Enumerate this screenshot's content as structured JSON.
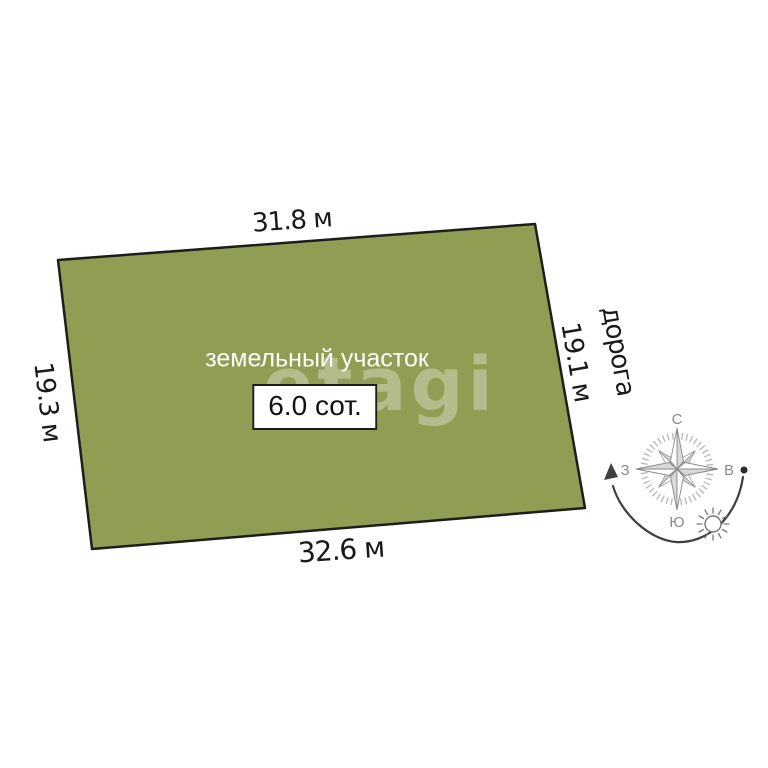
{
  "diagram": {
    "plot_label": "земельный участок",
    "area_label": "6.0 сот.",
    "dimensions": {
      "top": "31.8 м",
      "left": "19.3 м",
      "right": "19.1 м",
      "bottom": "32.6 м"
    },
    "road_label": "дорога",
    "colors": {
      "plot_fill": "#909e54",
      "plot_border": "#1d1d1b",
      "compass_grey": "#8a8a8a",
      "arrow_dark": "#3f3f3f"
    }
  },
  "compass": {
    "north": "С",
    "east": "В",
    "south": "Ю",
    "west": "З"
  },
  "watermark": "etagi"
}
